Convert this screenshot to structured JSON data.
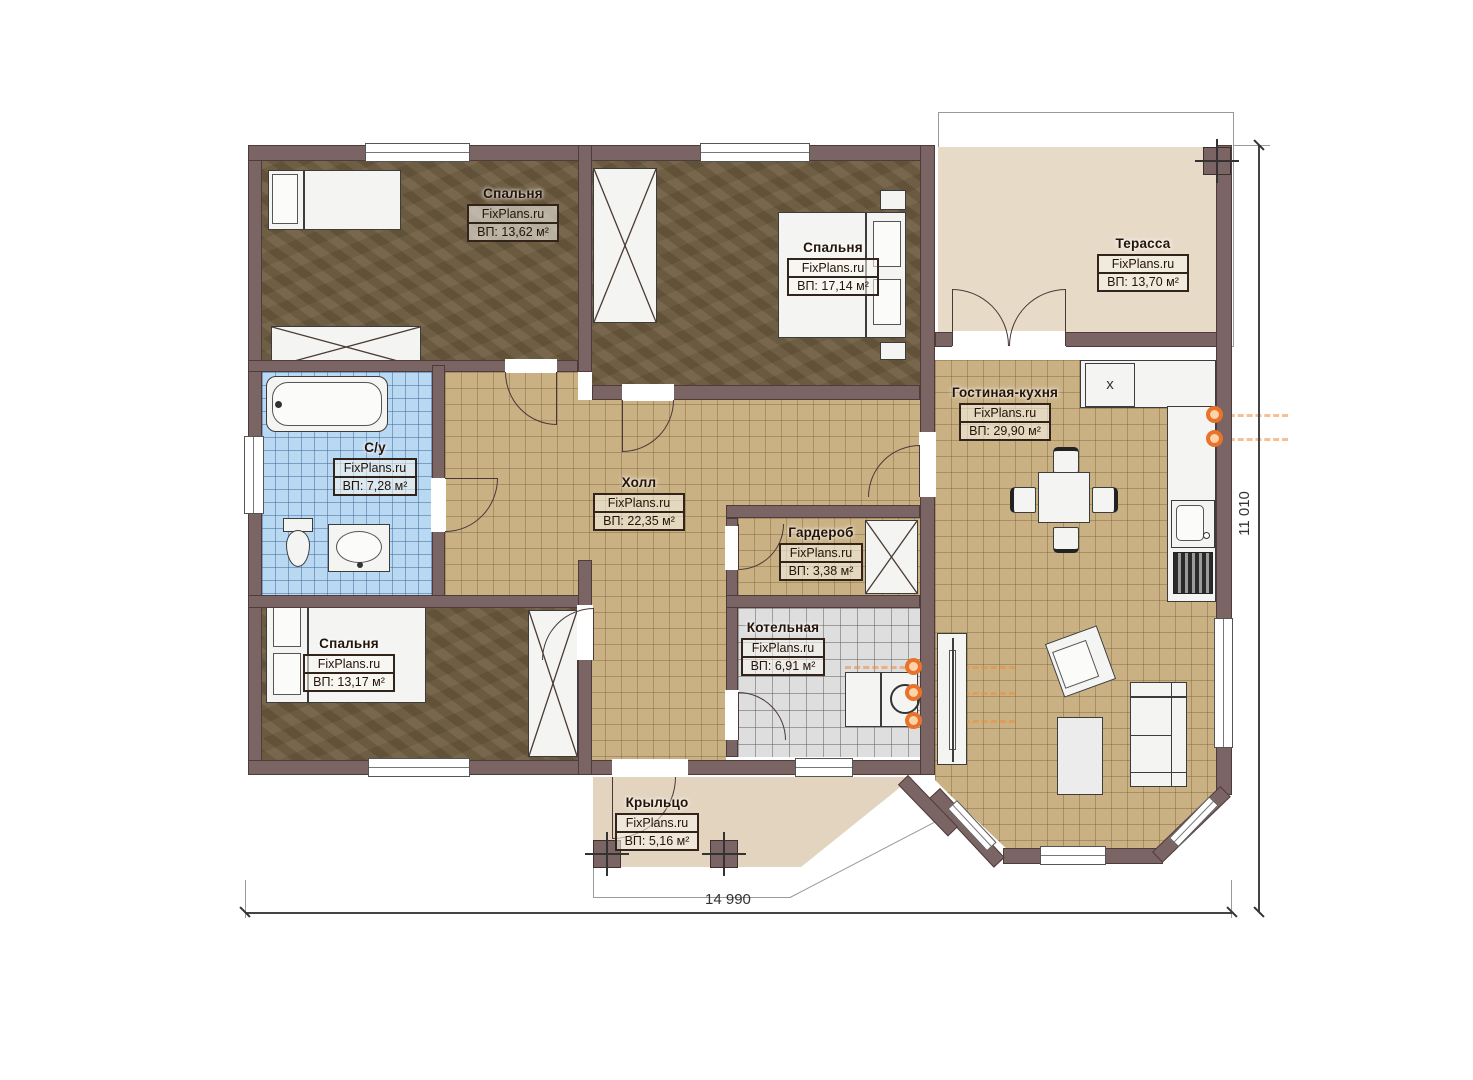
{
  "watermark": "FixPlans.ru",
  "rooms": [
    {
      "name": "Спальня",
      "site": "FixPlans.ru",
      "area": "ВП: 13,62 м²"
    },
    {
      "name": "Спальня",
      "site": "FixPlans.ru",
      "area": "ВП: 17,14 м²"
    },
    {
      "name": "Терасса",
      "site": "FixPlans.ru",
      "area": "ВП: 13,70 м²"
    },
    {
      "name": "С/у",
      "site": "FixPlans.ru",
      "area": "ВП: 7,28 м²"
    },
    {
      "name": "Холл",
      "site": "FixPlans.ru",
      "area": "ВП: 22,35 м²"
    },
    {
      "name": "Гостиная-кухня",
      "site": "FixPlans.ru",
      "area": "ВП: 29,90 м²"
    },
    {
      "name": "Гардероб",
      "site": "FixPlans.ru",
      "area": "ВП: 3,38 м²"
    },
    {
      "name": "Спальня",
      "site": "FixPlans.ru",
      "area": "ВП: 13,17 м²"
    },
    {
      "name": "Котельная",
      "site": "FixPlans.ru",
      "area": "ВП: 6,91 м²"
    },
    {
      "name": "Крыльцо",
      "site": "FixPlans.ru",
      "area": "ВП: 5,16 м²"
    }
  ],
  "dimensions": {
    "width": "14 990",
    "height": "11 010"
  },
  "kitchen": {
    "cabinet_mark": "x"
  },
  "colors": {
    "wall": "#7b6464",
    "tile_floor": "#c9b184",
    "bath_floor": "#b9d8f2",
    "boiler_floor": "#dedede",
    "bedroom_floor": "#6e5c3f",
    "terrace_floor": "#e7dbc8",
    "accent_orange": "#e8732c"
  }
}
